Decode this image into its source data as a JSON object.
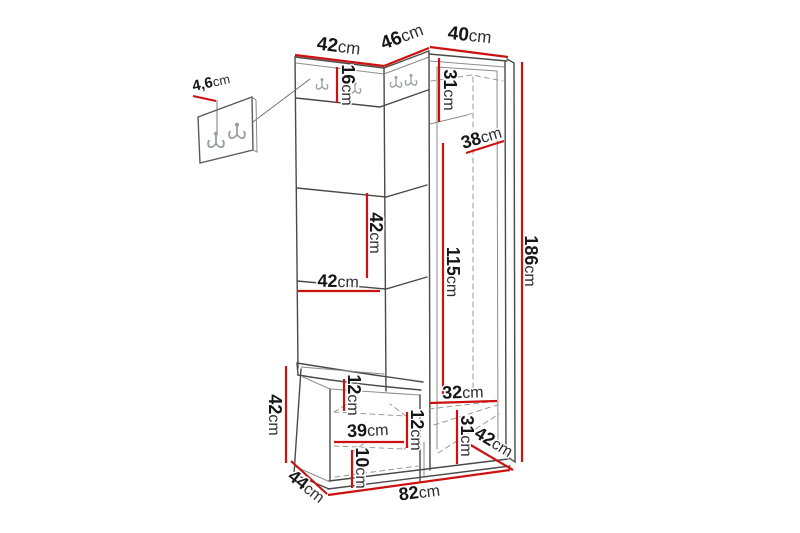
{
  "diagram": {
    "type": "furniture-dimension-drawing",
    "unit_system": "cm",
    "colors": {
      "dimension_line": "#cc1111",
      "outline": "#4a4a4a",
      "background": "#ffffff"
    },
    "dimensions": {
      "top_left_width": {
        "num": "42",
        "unit": "cm"
      },
      "top_middle_width": {
        "num": "46",
        "unit": "cm"
      },
      "top_right_width": {
        "num": "40",
        "unit": "cm"
      },
      "hook_detail_depth": {
        "num": "4,6",
        "unit": "cm"
      },
      "hook_rail_height": {
        "num": "16",
        "unit": "cm"
      },
      "wardrobe_top_height": {
        "num": "31",
        "unit": "cm"
      },
      "wardrobe_inner_depth": {
        "num": "38",
        "unit": "cm"
      },
      "open_shelf_height": {
        "num": "42",
        "unit": "cm"
      },
      "open_shelf_width": {
        "num": "42",
        "unit": "cm"
      },
      "wardrobe_door_height": {
        "num": "115",
        "unit": "cm"
      },
      "total_height": {
        "num": "186",
        "unit": "cm"
      },
      "bench_height": {
        "num": "42",
        "unit": "cm"
      },
      "bench_top_gap_height": {
        "num": "12",
        "unit": "cm"
      },
      "bench_opening_width": {
        "num": "39",
        "unit": "cm"
      },
      "bench_opening_height": {
        "num": "12",
        "unit": "cm"
      },
      "bench_drawer_height": {
        "num": "10",
        "unit": "cm"
      },
      "bench_depth": {
        "num": "44",
        "unit": "cm"
      },
      "total_width": {
        "num": "82",
        "unit": "cm"
      },
      "wardrobe_bottom_width": {
        "num": "32",
        "unit": "cm"
      },
      "wardrobe_bottom_height": {
        "num": "31",
        "unit": "cm"
      },
      "wardrobe_side_depth": {
        "num": "42",
        "unit": "cm"
      }
    }
  }
}
